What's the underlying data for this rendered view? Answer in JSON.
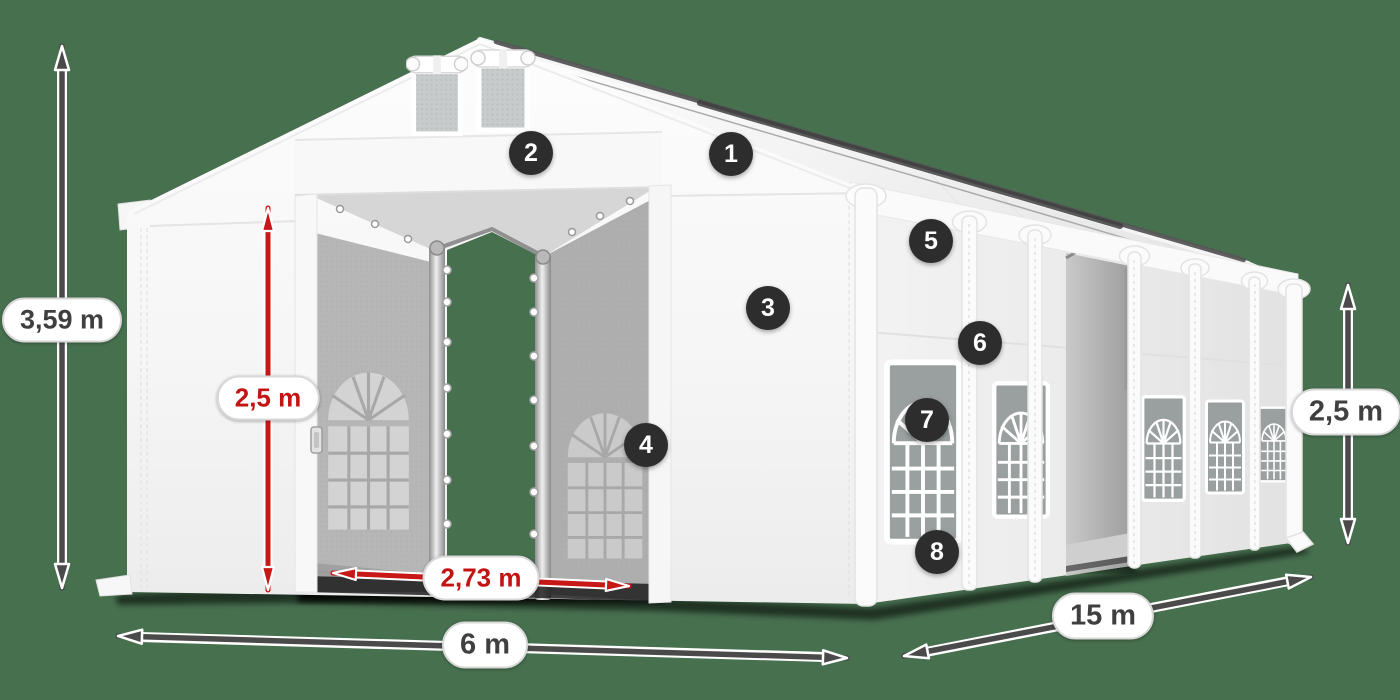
{
  "scene": {
    "background_color": "#47704f",
    "dimension_arrow_color": "#4a4a4a",
    "highlight_arrow_color": "#c81717",
    "tent_color": "#f5f5f5"
  },
  "badges": [
    {
      "label": "1"
    },
    {
      "label": "2"
    },
    {
      "label": "3"
    },
    {
      "label": "4"
    },
    {
      "label": "5"
    },
    {
      "label": "6"
    },
    {
      "label": "7"
    },
    {
      "label": "8"
    }
  ],
  "dimensions": {
    "total_height": "3,59 m",
    "entrance_height": "2,5 m",
    "entrance_width": "2,73 m",
    "front_width": "6 m",
    "side_length": "15 m",
    "side_wall_height": "2,5 m"
  }
}
